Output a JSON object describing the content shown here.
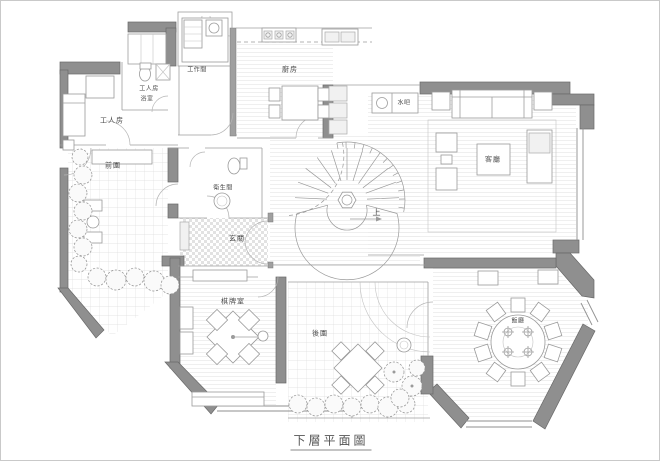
{
  "caption": {
    "text": "下層平面圖"
  },
  "labels": {
    "maid_room": "工人房",
    "maid_bathroom_line1": "工人房",
    "maid_bathroom_line2": "浴室",
    "workroom": "工作間",
    "kitchen": "廚房",
    "water_bar": "水吧",
    "living_room": "客廳",
    "stairs_up": "上",
    "front_garden": "前園",
    "bathroom": "衛生間",
    "foyer": "玄關",
    "mahjong_room": "棋牌室",
    "back_garden": "後園",
    "dining_room": "飯廳"
  },
  "colors": {
    "wall_fill": "#8f8f8f",
    "wall_edge": "#686868",
    "drawing_line": "#9a9a9a",
    "floor_line": "#ebebeb",
    "label_text": "#4a4a4a",
    "paper": "#ffffff"
  }
}
